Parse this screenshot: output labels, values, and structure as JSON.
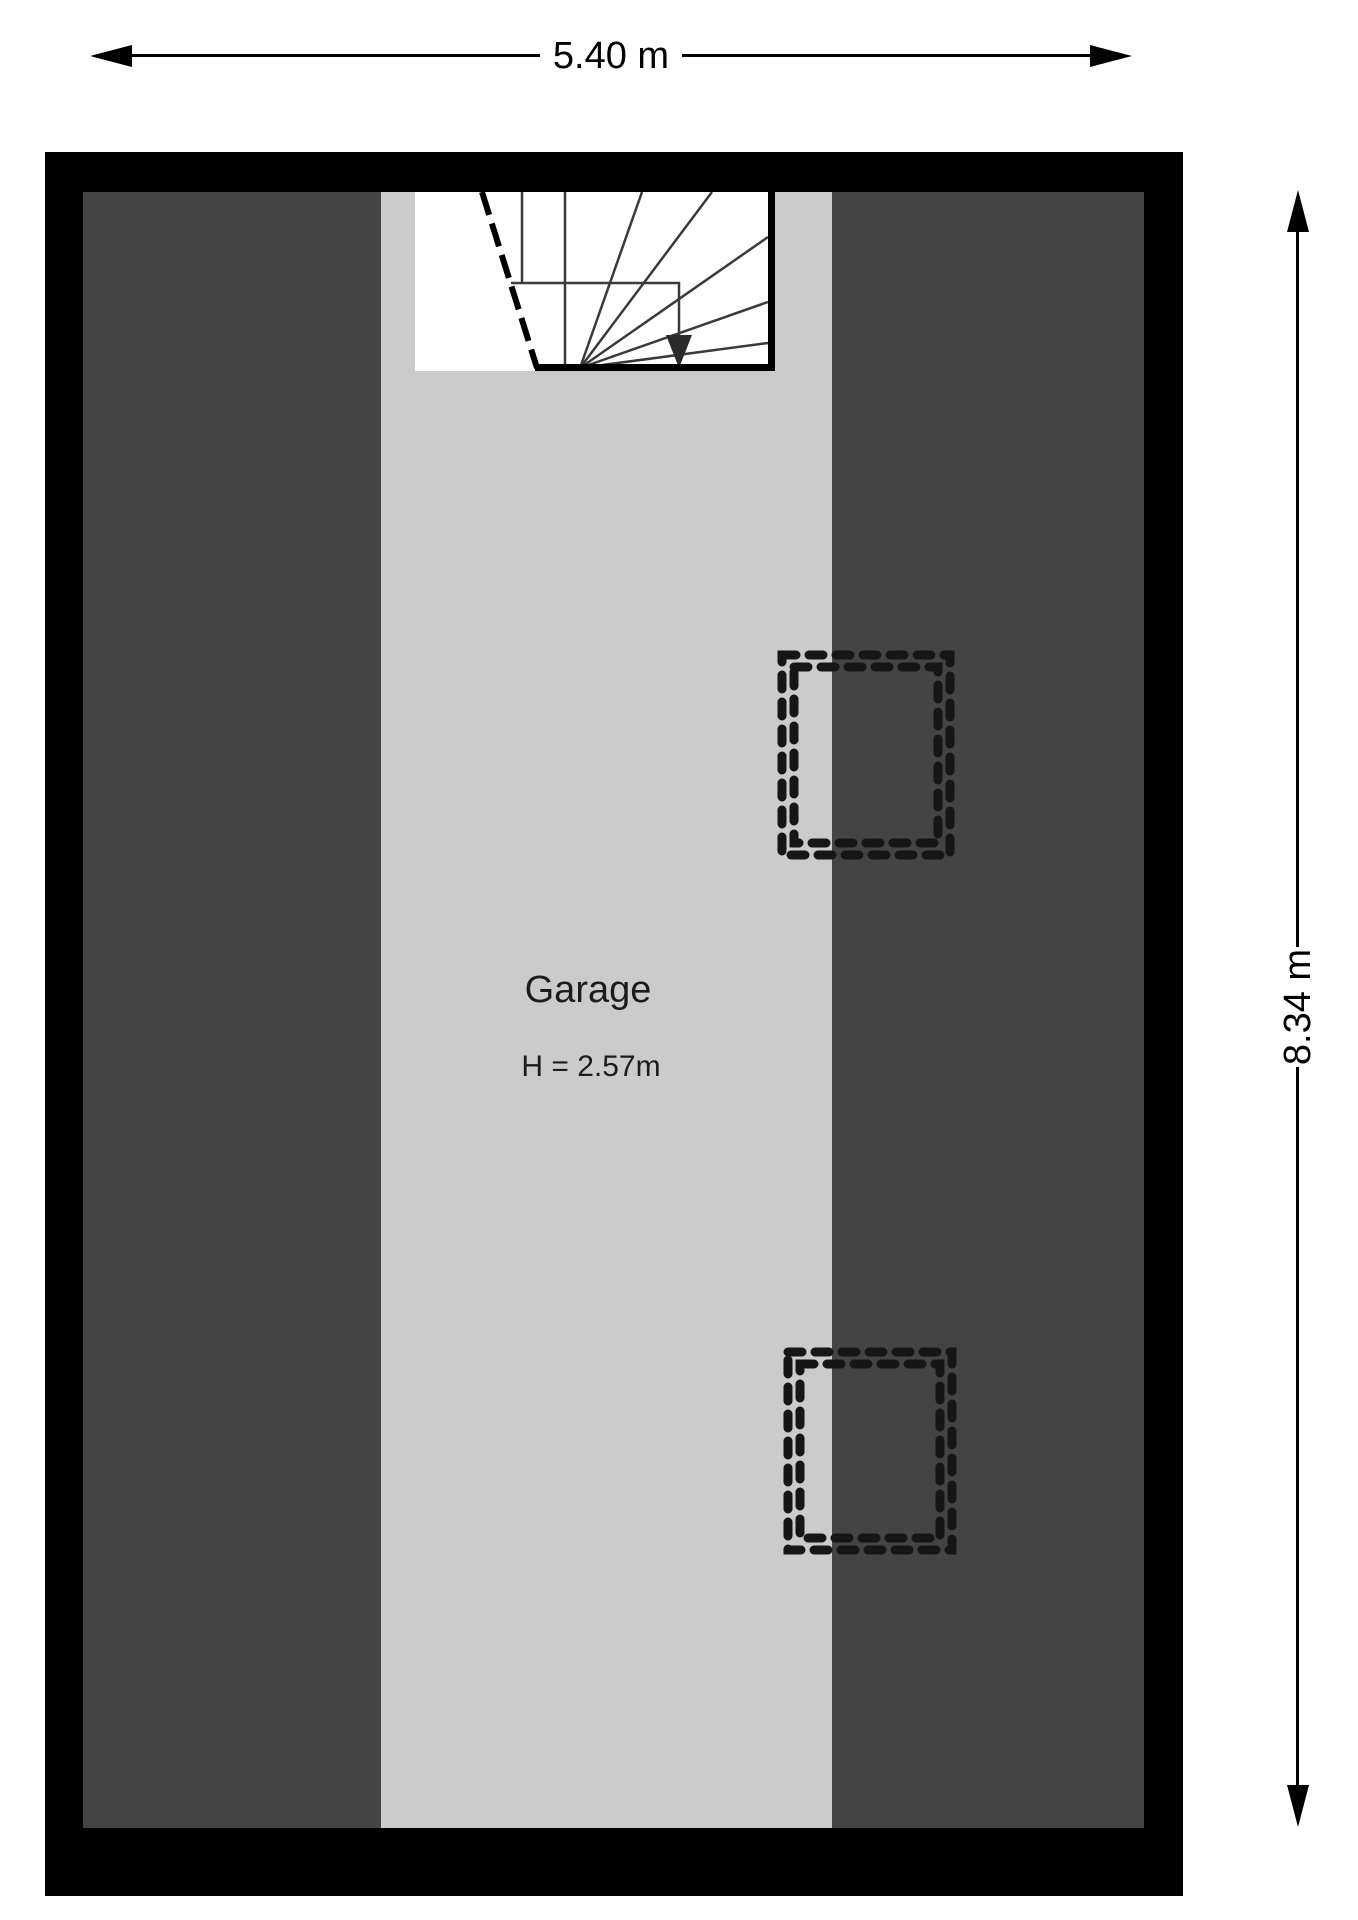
{
  "plan": {
    "type": "floorplan",
    "room": {
      "name": "Garage",
      "ceiling_height": "H = 2.57m"
    },
    "dimensions": {
      "width_label": "5.40 m",
      "height_label": "8.34 m"
    },
    "colors": {
      "wall": "#000000",
      "roof_slope_area": "#444444",
      "floor_area": "#cbcbcb",
      "staircase_fill": "#ffffff",
      "line": "#1c1c1c"
    },
    "icons": {
      "width_dimension_arrows": [
        "dim-arrow-left-icon",
        "dim-arrow-right-icon"
      ],
      "height_dimension_arrows": [
        "dim-arrow-up-icon",
        "dim-arrow-down-icon"
      ],
      "stair_direction": "stair-direction-arrow-icon",
      "roof_windows": [
        "roof-window-dashed",
        "roof-window-dashed"
      ]
    }
  }
}
